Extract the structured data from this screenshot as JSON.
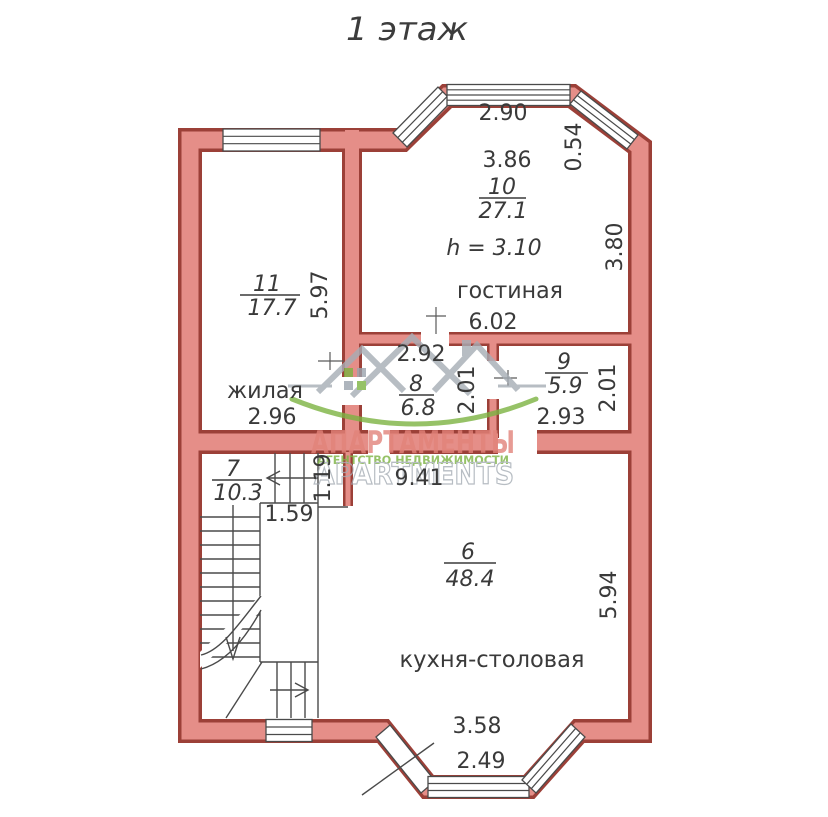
{
  "page_title": "1 этаж",
  "rooms": {
    "room_10": {
      "number": "10",
      "area": "27.1",
      "name": "гостиная",
      "ceiling_height": "h = 3.10",
      "dim_bay_width": "2.90",
      "dim_top_width": "3.86",
      "dim_bay_side": "0.54",
      "dim_right_depth": "3.80",
      "dim_bottom_width": "6.02"
    },
    "room_11": {
      "number": "11",
      "area": "17.7",
      "name": "жилая",
      "dim_right_depth": "5.97",
      "dim_bottom_width": "2.96"
    },
    "room_8": {
      "number": "8",
      "area": "6.8",
      "dim_top_width": "2.92",
      "dim_right_depth": "2.01"
    },
    "room_9": {
      "number": "9",
      "area": "5.9",
      "dim_bottom_width": "2.93",
      "dim_right_depth": "2.01"
    },
    "room_7": {
      "number": "7",
      "area": "10.3",
      "dim_bottom_width": "1.59",
      "dim_side": "1.19"
    },
    "room_6": {
      "number": "6",
      "area": "48.4",
      "name": "кухня-столовая",
      "dim_top_width": "9.41",
      "dim_right_depth": "5.94",
      "dim_bottom_width": "3.58",
      "dim_bay_width": "2.49"
    }
  },
  "watermark": {
    "brand_ru": "АПАРТАМЕНТЫ",
    "tagline": "АГЕНТСТВО НЕДВИЖИМОСТИ",
    "brand_en": "APARTMENTS"
  },
  "colors": {
    "wall_fill": "#e58e88",
    "wall_outline": "#9c4038",
    "line": "#4a4a4a",
    "text": "#3a3a3a",
    "watermark_red": "#e2837a",
    "watermark_green": "#7cb342",
    "watermark_gray": "#a6adb5"
  }
}
